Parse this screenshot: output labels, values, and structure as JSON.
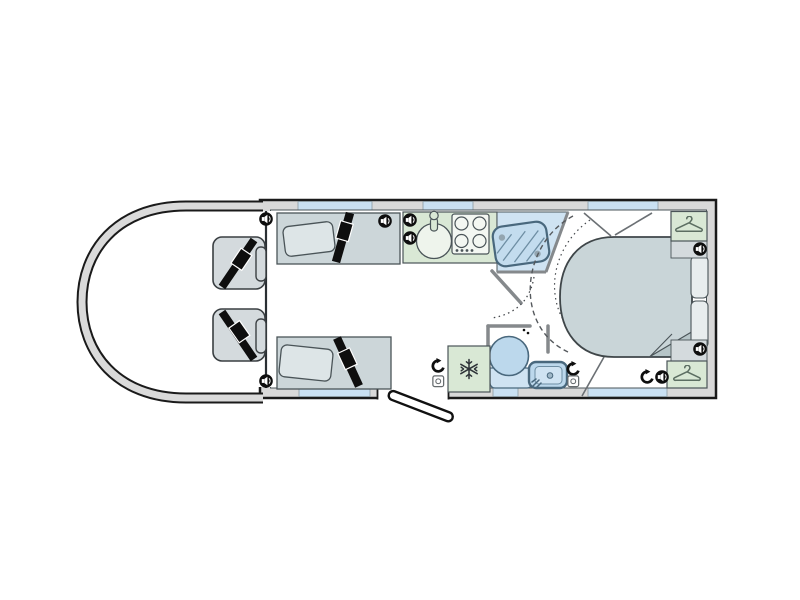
{
  "figure": {
    "kind": "motorhome floor plan diagram",
    "background": "#ffffff"
  },
  "palette": {
    "outline": "#1a1a1a",
    "wall_band": "#d9d9d9",
    "inner_wall": "#4a5458",
    "wall_gray": "#85898c",
    "seat_upholstery": "#ccd6d9",
    "seat_cab": "#d4dadd",
    "pillow": "#dde5e7",
    "cabinet_green": "#d9e8d5",
    "hob_panel": "#f3f7f2",
    "sink_white": "#eef4ec",
    "water_fixture": "#bcd8ec",
    "shower_floor": "#cfe3f2",
    "window": "#c9e0f2",
    "bed": "#c9d5d8",
    "blanket_fold": "#b6c5c8",
    "belt_black": "#0e0e0e",
    "icon_black": "#0e0e0e",
    "hanger_green": "#5c6e62"
  },
  "areas": {
    "cab": {
      "features": [
        "swivel-seat-with-seatbelt",
        "swivel-seat-with-seatbelt",
        "speaker",
        "speaker"
      ]
    },
    "lounge": {
      "features": [
        "bench-seat-with-seatbelt",
        "bench-seat-with-seatbelt",
        "pillow",
        "pillow",
        "speaker",
        "entry-door-open"
      ]
    },
    "kitchen": {
      "features": [
        "round-sink-with-tap",
        "four-burner-hob",
        "control-knobs",
        "speaker",
        "speaker"
      ]
    },
    "washroom": {
      "features": [
        "shower-cubicle",
        "toilet",
        "washbasin-with-tap",
        "heating-outlet",
        "socket",
        "door-swing-arcs"
      ]
    },
    "fridge": {
      "features": [
        "refrigerator-snowflake",
        "heating-outlet",
        "socket"
      ]
    },
    "bedroom": {
      "features": [
        "island-bed",
        "blanket-fold",
        "wardrobe",
        "wardrobe",
        "bedside-cabinet",
        "bedside-cabinet",
        "speaker",
        "speaker",
        "speaker",
        "heating-outlet",
        "sliding-partition-dashed-arc"
      ]
    }
  },
  "icon_counts": {
    "speaker": 8,
    "heating_outlet": 3,
    "socket": 2,
    "hanger": 2,
    "snowflake": 1
  },
  "windows": {
    "top_wall": 3,
    "bottom_wall": 3,
    "door_opening_bottom": 1
  }
}
